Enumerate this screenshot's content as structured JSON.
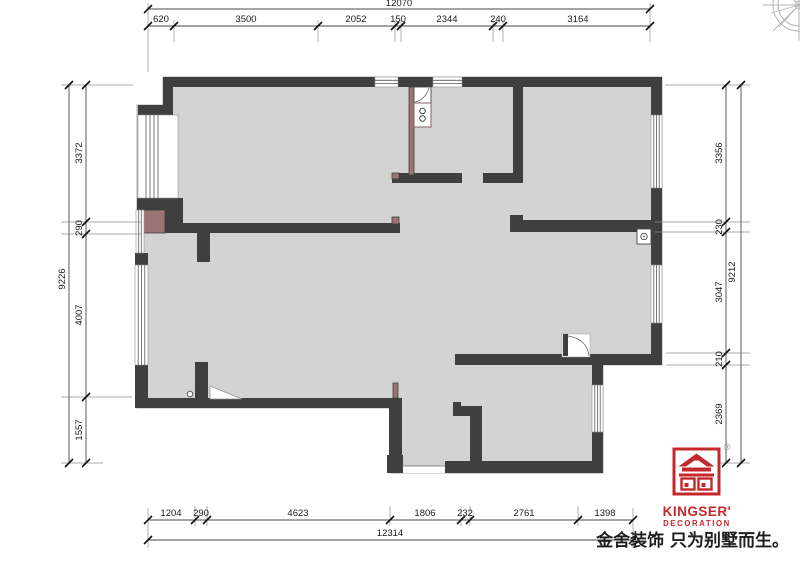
{
  "plan": {
    "top_dims": {
      "total": "12070",
      "segments": [
        "620",
        "3500",
        "2052",
        "150",
        "2344",
        "240",
        "3164"
      ]
    },
    "left_dims": {
      "total": "9226",
      "segments": [
        "3372",
        "290",
        "4007",
        "1557"
      ]
    },
    "right_dims": {
      "total": "9212",
      "segments": [
        "3356",
        "230",
        "3047",
        "210",
        "2369"
      ]
    },
    "bottom_dims": {
      "total": "12314",
      "segments": [
        "1204",
        "290",
        "4623",
        "1806",
        "232",
        "2761",
        "1398"
      ]
    }
  },
  "branding": {
    "brand_name": "KINGSER'",
    "brand_sub": "DECORATION",
    "registered": "®",
    "slogan": "金舍装饰 只为别墅而生。"
  },
  "colors": {
    "wall": "#3f3f3f",
    "floor": "#d3d3d3",
    "accent_wall": "#9d7474",
    "brand_red": "#c5272d",
    "dim_line": "#4a4a4a"
  }
}
